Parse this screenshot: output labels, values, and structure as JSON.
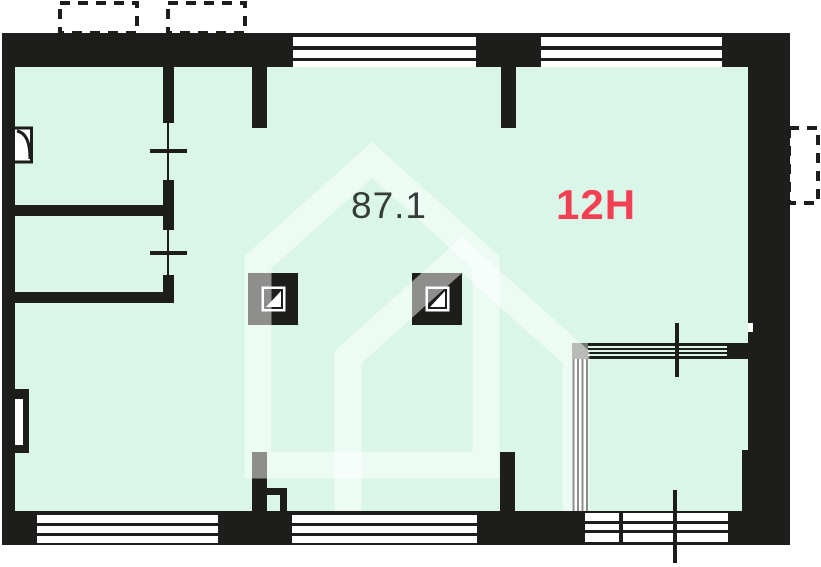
{
  "floorplan": {
    "area_label": "87.1",
    "unit_label": "12H",
    "colors": {
      "interior_fill": "#d9f6e8",
      "wall": "#1d1d1b",
      "area_label_text": "#363c39",
      "unit_label_accent": "#f43f52",
      "glazing_corner_gray": "#70776f",
      "watermark_overlay": "rgba(255,255,255,0.5)",
      "window_white": "#ffffff"
    },
    "icons": {
      "vent_shaft": "vent-shaft-icon (black square, white framed inner square with diagonal half-fill)",
      "door_swing": "door-swing-icon (door leaf arc on left wall)",
      "window_tick": "window-tick-icon (cross tick on glazed opening)",
      "radiator_niche": "radiator-niche-icon (U-shaped niche on left wall)",
      "watermark_house": "watermark-house-icon (translucent house outline)",
      "balcony_outline": "balcony-outline (dashed rectangle outside walls)"
    }
  }
}
